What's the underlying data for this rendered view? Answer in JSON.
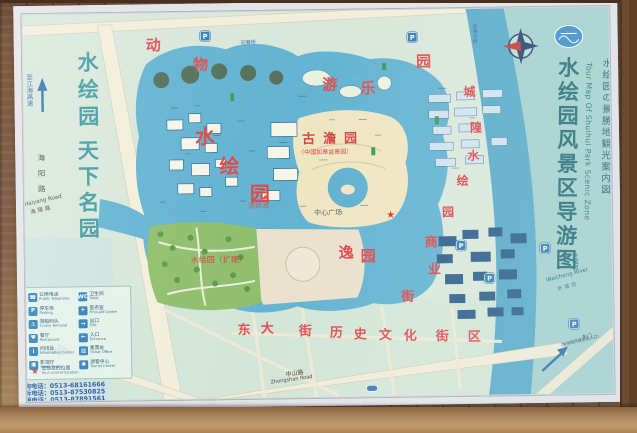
{
  "board": {
    "logo": "scenic-area-logo",
    "title": {
      "cn": "水绘园风景区导游图",
      "en": "Tour Map Of Shuihui Park Scenic Zone",
      "jp": "水绘园の景勝地観光案内図"
    }
  },
  "map": {
    "labels": [
      {
        "text": "水绘园",
        "x": 78,
        "y": 48,
        "size": 21,
        "color": "#3f9aa2",
        "v": "up",
        "ls": 6,
        "bold": true,
        "name": "park-slogan-line1"
      },
      {
        "text": "天下名园",
        "x": 77,
        "y": 136,
        "size": 21,
        "color": "#3f9aa2",
        "v": "up",
        "ls": 5,
        "bold": true,
        "name": "park-slogan-line2"
      },
      {
        "text": "至江海高速",
        "x": 27,
        "y": 70,
        "size": 6.5,
        "color": "#2e6fae",
        "v": "up",
        "name": "to-expressway-label"
      },
      {
        "text": "海阳路",
        "x": 38,
        "y": 150,
        "size": 7.5,
        "color": "#4a4a3a",
        "v": "up",
        "ls": 8,
        "name": "haiyang-road-label-cn"
      },
      {
        "text": "Haiyang Road",
        "x": 24,
        "y": 199,
        "size": 5.5,
        "color": "#4a4a3a",
        "rot": -12,
        "name": "haiyang-road-label-en"
      },
      {
        "text": "海陽路",
        "x": 30,
        "y": 207,
        "size": 5.5,
        "color": "#4a4a3a",
        "rot": -12,
        "ls": 2,
        "name": "haiyang-road-label-jp"
      },
      {
        "text": "迎春桥",
        "x": 243,
        "y": 40,
        "size": 5,
        "color": "#3a6ea0",
        "name": "yingchun-bridge-label"
      },
      {
        "text": "迎春大桥",
        "x": 474,
        "y": 26,
        "size": 5,
        "color": "#3a6ea0",
        "v": "up",
        "name": "yingchun-grand-bridge-label"
      },
      {
        "text": "古澹园",
        "x": 303,
        "y": 133,
        "size": 13,
        "color": "#d34747",
        "ls": 8,
        "bold": true,
        "name": "gudan-garden-label"
      },
      {
        "text": "（中国如皋盆景园）",
        "x": 299,
        "y": 150,
        "size": 6,
        "color": "#d34747",
        "name": "gudan-garden-sublabel"
      },
      {
        "text": "中心广场",
        "x": 314,
        "y": 210,
        "size": 7,
        "color": "#5a6378",
        "name": "central-plaza-label"
      },
      {
        "text": "洗钵池",
        "x": 248,
        "y": 202,
        "size": 7,
        "color": "#bf5a50",
        "name": "xibo-pond-label"
      },
      {
        "text": "水绘园（扩建）",
        "x": 190,
        "y": 255,
        "size": 8,
        "color": "#d34747",
        "name": "expansion-area-label"
      },
      {
        "text": "中山路",
        "x": 283,
        "y": 372,
        "size": 6,
        "color": "#4a4a3a",
        "rot": -7,
        "name": "zhongshan-road-label-cn"
      },
      {
        "text": "Zhongshan Road",
        "x": 268,
        "y": 380,
        "size": 5,
        "color": "#4a4a3a",
        "rot": -7,
        "name": "zhongshan-road-label-en"
      },
      {
        "text": "外城河",
        "x": 570,
        "y": 256,
        "size": 6,
        "color": "#1f6b7a",
        "v": "up",
        "name": "waicheng-river-label-v"
      },
      {
        "text": "Waicheng River",
        "x": 545,
        "y": 282,
        "size": 5.5,
        "color": "#1f6b7a",
        "rot": -14,
        "name": "waicheng-river-label-en"
      },
      {
        "text": "外城河",
        "x": 556,
        "y": 291,
        "size": 5,
        "color": "#1f6b7a",
        "rot": -14,
        "ls": 2,
        "name": "waicheng-river-label-cn"
      },
      {
        "text": "东门",
        "x": 580,
        "y": 340,
        "size": 5,
        "color": "#35404a",
        "rot": -12,
        "name": "east-gate-label"
      },
      {
        "text": "（水绘园风景区出入口）",
        "x": 556,
        "y": 347,
        "size": 4,
        "color": "#35404a",
        "rot": -12,
        "name": "east-gate-sublabel"
      }
    ],
    "spread_labels": [
      {
        "text": "动物游乐园",
        "size": 15,
        "color": "#e05050",
        "positions": [
          [
            148,
            36
          ],
          [
            195,
            56
          ],
          [
            324,
            78
          ],
          [
            362,
            82
          ],
          [
            418,
            56
          ]
        ],
        "name": "amusement-zone-label"
      },
      {
        "text": "水绘园",
        "size": 20,
        "color": "#e04848",
        "positions": [
          [
            196,
            125
          ],
          [
            220,
            155
          ],
          [
            250,
            183
          ]
        ],
        "name": "shuihui-garden-label"
      },
      {
        "text": "逸园",
        "size": 15,
        "color": "#e04848",
        "positions": [
          [
            338,
            246
          ],
          [
            360,
            250
          ]
        ],
        "name": "yi-garden-label"
      },
      {
        "text": "商业街",
        "size": 13,
        "color": "#e04848",
        "positions": [
          [
            424,
            238
          ],
          [
            427,
            265
          ],
          [
            400,
            292
          ]
        ],
        "name": "commercial-street-label"
      },
      {
        "text": "东大街历史文化街区",
        "size": 13,
        "color": "#e05050",
        "positions": [
          [
            236,
            323
          ],
          [
            259,
            322
          ],
          [
            297,
            325
          ],
          [
            328,
            327
          ],
          [
            352,
            329
          ],
          [
            377,
            330
          ],
          [
            402,
            331
          ],
          [
            434,
            332
          ],
          [
            466,
            333
          ]
        ],
        "name": "dongdajie-historic-district-label"
      },
      {
        "text": "城隍",
        "size": 12,
        "color": "#e04848",
        "positions": [
          [
            465,
            88
          ],
          [
            471,
            124
          ]
        ],
        "name": "chenghuang-label"
      },
      {
        "text": "水绘园",
        "size": 12,
        "color": "#e04848",
        "positions": [
          [
            468,
            152
          ],
          [
            457,
            177
          ],
          [
            442,
            208
          ]
        ],
        "name": "shuihui-east-label"
      }
    ],
    "markers": {
      "parking_glyph": "P",
      "parking_positions": [
        [
          203,
          30
        ],
        [
          410,
          34
        ],
        [
          456,
          243
        ],
        [
          484,
          276
        ],
        [
          568,
          323
        ],
        [
          540,
          247
        ]
      ],
      "star_glyph": "★",
      "star_positions": [
        [
          386,
          212
        ]
      ]
    },
    "legend": {
      "left": [
        {
          "glyph": "☎",
          "name": "public-telephone-icon",
          "cn": "公用电话",
          "en": "Public Telephone"
        },
        {
          "glyph": "P",
          "name": "parking-icon",
          "cn": "停车场",
          "en": "Parking"
        },
        {
          "glyph": "⚓",
          "name": "cruise-terminal-icon",
          "cn": "游船码头",
          "en": "Cruise Terminal"
        },
        {
          "glyph": "Ψ",
          "name": "restaurant-icon",
          "cn": "餐厅",
          "en": "Restaurant"
        },
        {
          "glyph": "i",
          "name": "information-icon",
          "cn": "问讯处",
          "en": "Information Center"
        },
        {
          "glyph": "▣",
          "name": "video-room-icon",
          "cn": "影视厅",
          "en": "Video Room"
        }
      ],
      "right": [
        {
          "glyph": "WC",
          "name": "toilet-icon",
          "cn": "卫生间",
          "en": "Toilet"
        },
        {
          "glyph": "+",
          "name": "first-aid-icon",
          "cn": "医务室",
          "en": "First-aid Center"
        },
        {
          "glyph": "→",
          "name": "exit-icon",
          "cn": "出口",
          "en": "Exit"
        },
        {
          "glyph": "←",
          "name": "entrance-icon",
          "cn": "入口",
          "en": "Entrance"
        },
        {
          "glyph": "▤",
          "name": "ticket-office-icon",
          "cn": "售票处",
          "en": "Ticket Office"
        },
        {
          "glyph": "◉",
          "name": "visitor-center-icon",
          "cn": "游客中心",
          "en": "Tourist Center"
        }
      ],
      "current_location": {
        "cn": "您现在的位置",
        "en": "Your current location"
      },
      "phones": [
        "咨询电话：0513-68161666",
        "投诉电话：0513-87530825",
        "救援电话：0513-87891561"
      ]
    }
  }
}
